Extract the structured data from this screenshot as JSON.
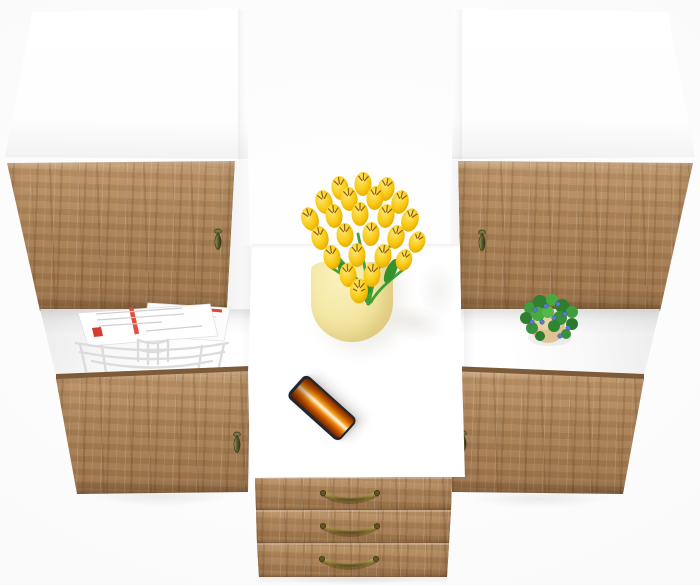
{
  "meta": {
    "type": "3d-product-render",
    "subject": "White and craft-oak wall storage unit with desk, three drawers, open shelves and decor, viewed from above"
  },
  "palette": {
    "bg": "#f7f7f7",
    "cabinet_white": "#ffffff",
    "wood_base": "#a87f54",
    "wood_light": "#bd9468",
    "wood_dark": "#7d5a38",
    "knob_olive": "#55562a",
    "brass": "#8d7d33",
    "tulip_yellow": "#f4c60f",
    "tulip_mark": "#7a4a00",
    "stem_green": "#3f9e35",
    "vase_cream": "#f3e49e",
    "phone_frame": "#23262f",
    "canyon_orange": "#e07812",
    "magazine_red": "#e04438",
    "wire_gray": "#dcdcdc",
    "leaf_green": "#3c9b38",
    "berry_blue": "#5b7ac9",
    "pot_tan": "#dfc392"
  },
  "scene": {
    "left_cabinet": {
      "label": "tall cabinet left",
      "sections": [
        "white upper panel",
        "oak upper door",
        "open shelf with magazine basket",
        "oak lower door"
      ],
      "handles": "olive teardrop knobs"
    },
    "right_cabinet": {
      "label": "tall cabinet right",
      "sections": [
        "white upper panel",
        "oak upper door",
        "open shelf with potted plant",
        "oak lower door"
      ],
      "handles": "olive teardrop knobs"
    },
    "desk": {
      "label": "white desk between cabinets",
      "items_on_top": [
        "vase with yellow tulips",
        "smartphone showing orange canyon wallpaper"
      ],
      "drawer_count": 3,
      "drawer_handle": "brass bail pulls"
    },
    "decor": {
      "tulip_count_approx": 24,
      "magazines": "white newspapers with red accents in white wire basket",
      "plant": "green plant with blue berries in tan pot"
    }
  }
}
